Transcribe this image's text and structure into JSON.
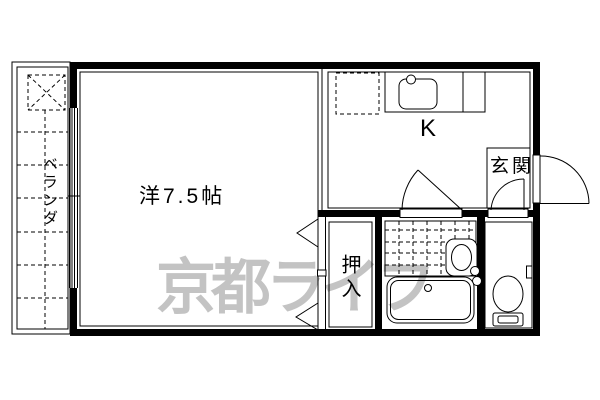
{
  "plan": {
    "type": "apartment-floorplan",
    "rooms": {
      "main_room": {
        "label": "洋7.5帖"
      },
      "kitchen": {
        "label": "K"
      },
      "entrance": {
        "label": "玄関"
      },
      "closet": {
        "label": "押入"
      },
      "balcony": {
        "label": "ベランダ"
      }
    },
    "watermark": {
      "text": "京都ライフ",
      "color": "#c3c3c3"
    },
    "colors": {
      "line": "#000000",
      "background": "#ffffff",
      "watermark": "#c3c3c3"
    },
    "icons": [
      "washing-machine-pan-icon",
      "sliding-window-icon",
      "refrigerator-space-icon",
      "kitchen-sink-icon",
      "faucet-icon",
      "door-swing-icon",
      "entrance-door-icon",
      "tile-floor-icon",
      "washbasin-icon",
      "bathtub-icon",
      "toilet-icon",
      "paper-holder-icon",
      "closet-door-chevron-icon"
    ]
  }
}
